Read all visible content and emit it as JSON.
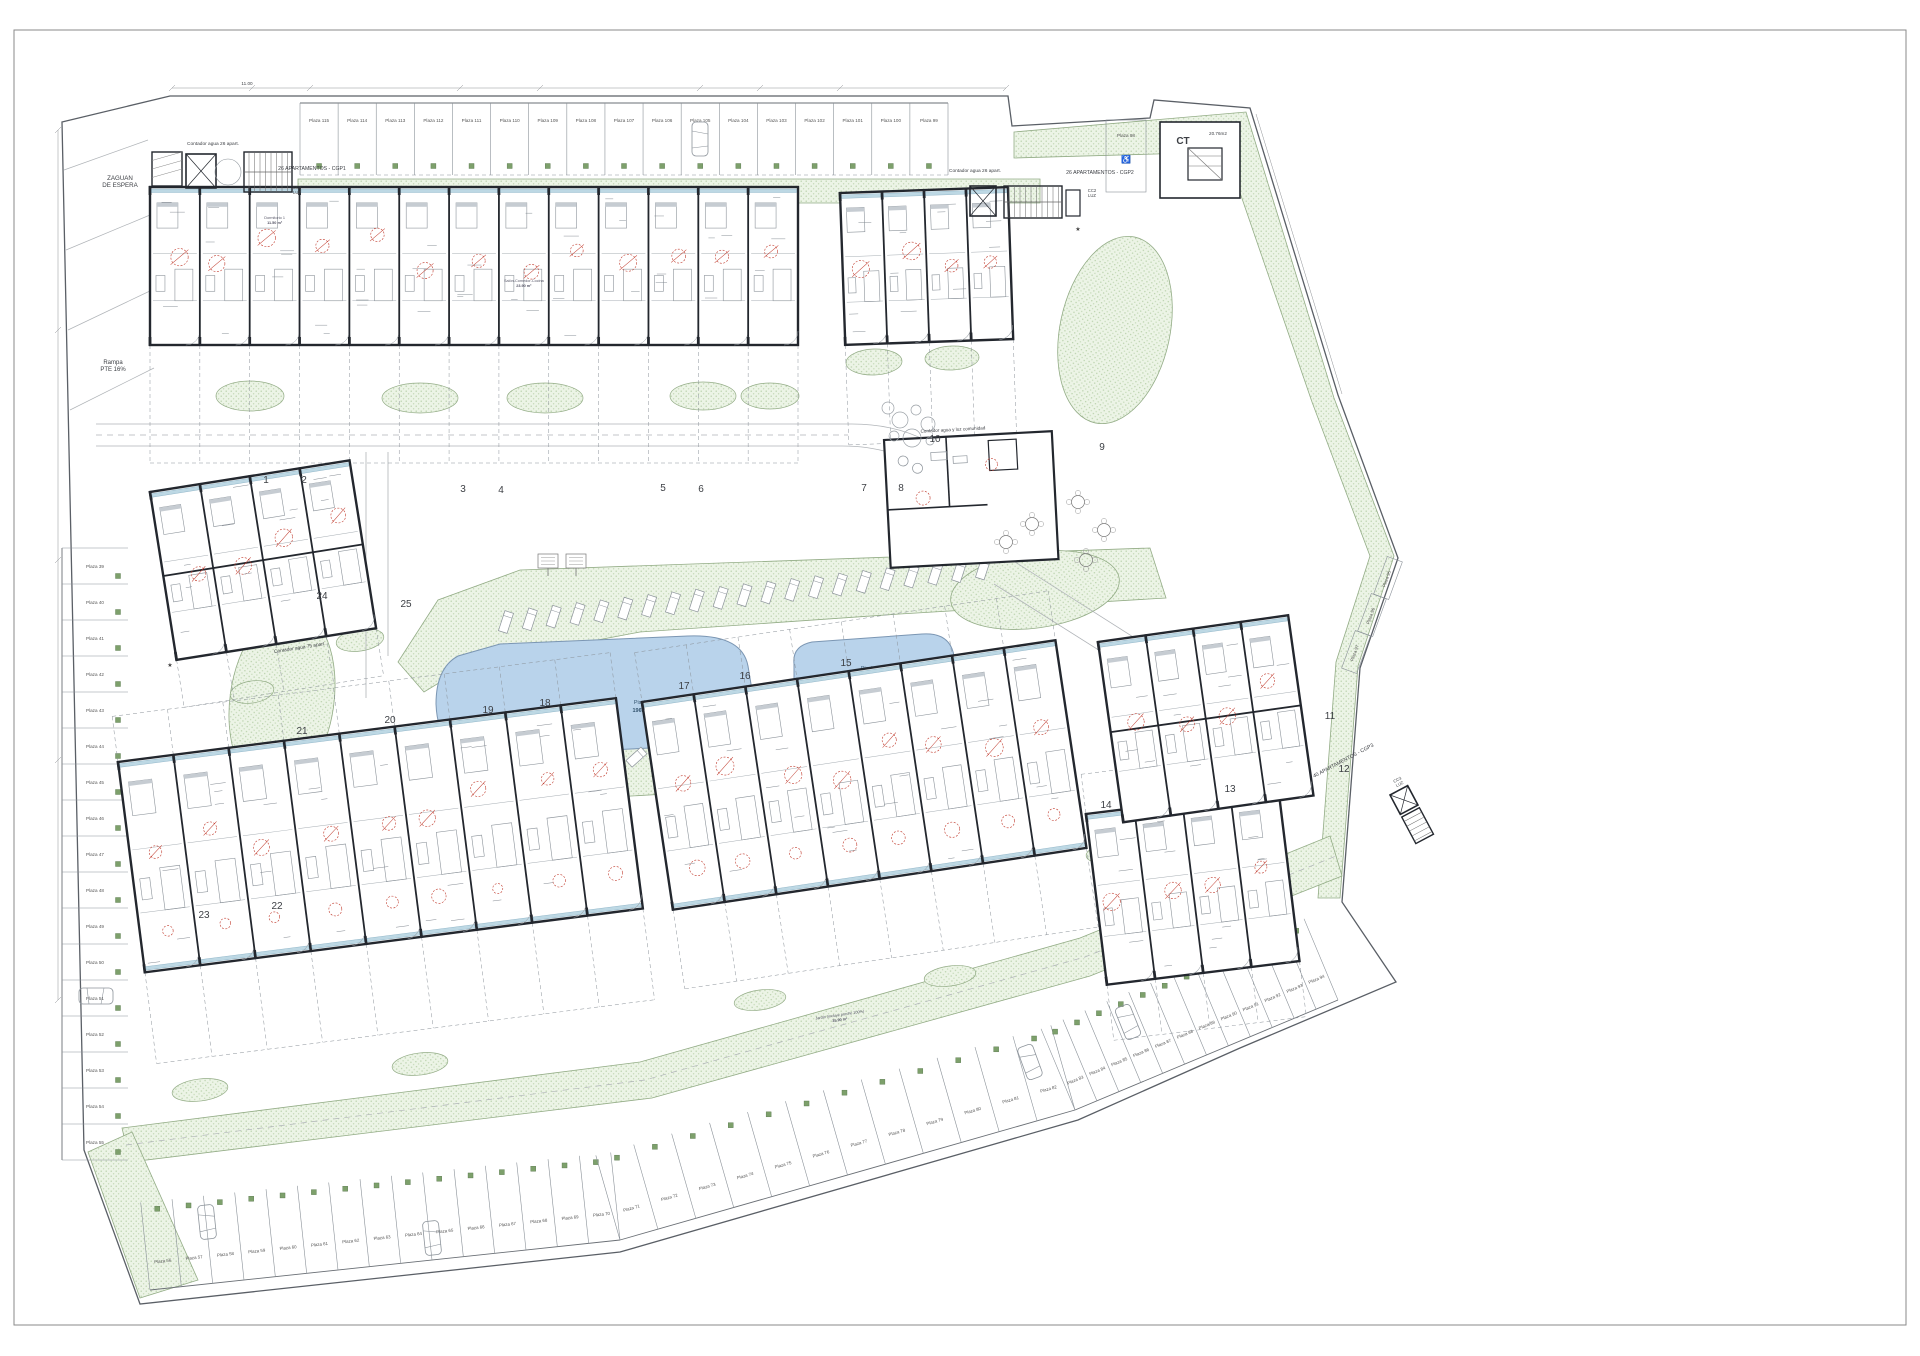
{
  "plan": {
    "labels": {
      "zaguan": [
        "ZAGUAN",
        "DE ESPERA"
      ],
      "rampa": [
        "Rampa",
        "PTE 16%"
      ],
      "contador_cgp1": "Contador agua 26 apart.",
      "cgp1": "26 APARTAMENTOS - CGP1",
      "cc1": [
        "CC1",
        "LUZ"
      ],
      "contador_cgp2": "Contador agua 26 apart.",
      "cgp2": "26 APARTAMENTOS - CGP2",
      "cc2": [
        "CC2",
        "LUZ"
      ],
      "cgp3": "40 APARTAMENTOS - CGP3",
      "cc3": [
        "CC3",
        "LUZ"
      ],
      "contador_west": "Contador agua 75 apart.",
      "contador_comunidad": "Contador agua y luz comunidad",
      "ct": "CT",
      "ct_area": "20.76m2",
      "dim_top": "11.00"
    },
    "pools": [
      {
        "name": "Piscina 1",
        "area": "196.30 m²"
      },
      {
        "name": "Piscina 2",
        "area": "36.90 m²"
      }
    ],
    "block_numbers": [
      "1",
      "2",
      "3",
      "4",
      "5",
      "6",
      "7",
      "8",
      "9",
      "10",
      "11",
      "12",
      "13",
      "14",
      "15",
      "16",
      "17",
      "18",
      "19",
      "20",
      "21",
      "22",
      "23",
      "24",
      "25"
    ],
    "parking": {
      "prefix": "Plaza",
      "top": [
        115,
        114,
        113,
        112,
        111,
        110,
        109,
        108,
        107,
        106,
        105,
        104,
        103,
        102,
        101,
        100,
        99
      ],
      "isolated": [
        98
      ],
      "left": [
        39,
        40,
        41,
        42,
        43,
        44,
        45,
        46,
        47,
        48,
        49,
        50,
        51,
        52,
        53,
        54,
        55
      ],
      "bottom": [
        56,
        57,
        58,
        59,
        60,
        61,
        62,
        63,
        64,
        65,
        66,
        67,
        68,
        69,
        70,
        71,
        72,
        73,
        74,
        75,
        76,
        77,
        78,
        79,
        80,
        81,
        82,
        83,
        84,
        85,
        86,
        87,
        88,
        89,
        90,
        91,
        92,
        93,
        94
      ],
      "right": [
        95,
        96,
        97
      ]
    },
    "unit_labels": [
      {
        "room": "Dormitorio 1",
        "area": "11.50 m²"
      },
      {
        "room": "Salón-Comedor-Cocina",
        "area": "23.90 m²"
      },
      {
        "room": "Jardín (incluye porche 100%)",
        "area": "35.90 m²"
      }
    ],
    "colors": {
      "wall": "#23272e",
      "green_fill": "#ecf4e6",
      "green_dot": "#b7cfa9",
      "pool_fill": "#b9d3eb",
      "pool_edge": "#7b96b3",
      "red_mark": "#c0392b",
      "teal_strip": "#bdd8e4"
    }
  }
}
